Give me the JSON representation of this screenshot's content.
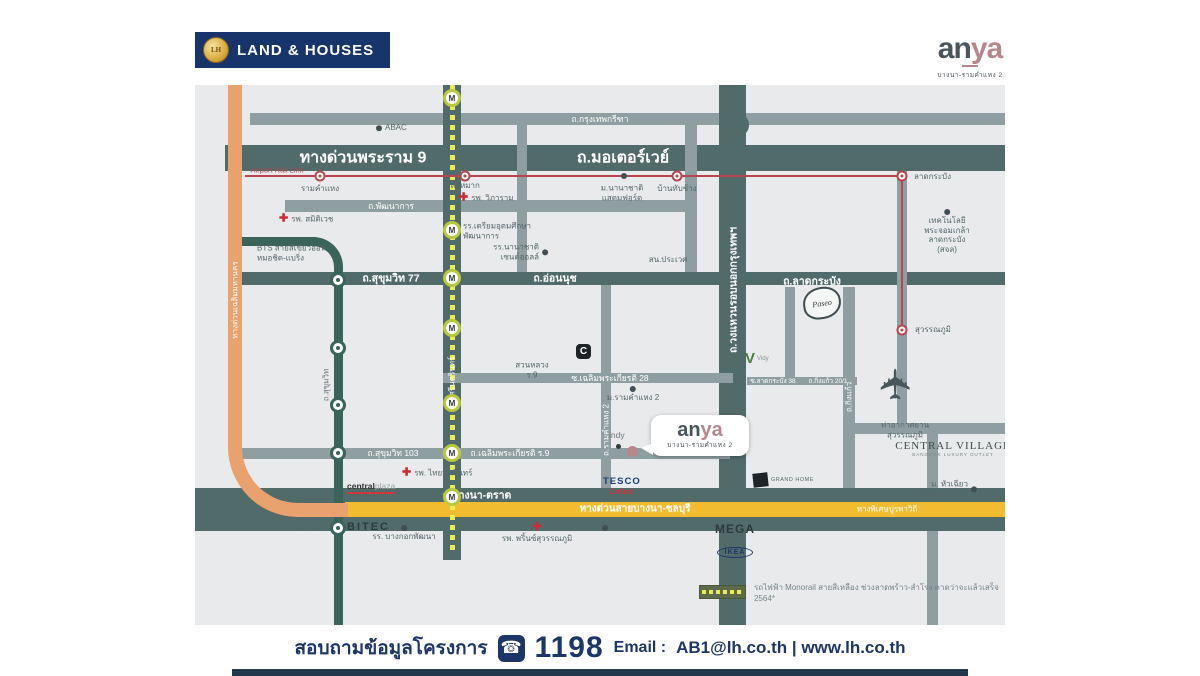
{
  "header": {
    "lh_logo_text": "LAND & HOUSES",
    "lh_coin": "LH",
    "anya_an": "an",
    "anya_ya": "ya",
    "anya_subtitle": "บางนา-รามคำแหง 2"
  },
  "bubble": {
    "an": "an",
    "ya": "ya",
    "subtitle": "บางนา-รามคำแหง 2"
  },
  "icons": {
    "plane": "✈",
    "phone": "☎",
    "cross": "✚",
    "monorail_station": "M"
  },
  "colors": {
    "navy": "#1c3667",
    "road_dark": "#516b6a",
    "road_medium": "#8f9fa1",
    "bts_green": "#3a635a",
    "monorail_yellow": "#e8ed55",
    "arl_red": "#b5454f",
    "expressway_orange": "#e9a16d",
    "bangna_yellow": "#f2bc30",
    "anya_pink": "#b5878c"
  },
  "logos": {
    "paseo": "Paseo",
    "v_mark": "V",
    "v_text": "Vidy",
    "grand_home": "GRAND HOME",
    "central_village_line1": "CENTRAL VILLAGE",
    "central_village_line2": "BANGKOK LUXURY OUTLET",
    "tesco": "TESCO",
    "lotus": "Lotus",
    "central": "central",
    "plaza": "plaza",
    "bitec": "BITEC",
    "mega": "MEGA",
    "mega_sub": "บางนา",
    "ikea": "IKEA",
    "indy": "indy",
    "c_mark": "C"
  },
  "legend": {
    "text": "รถไฟฟ้า Monorail สายสีเหลือง ช่วงลาดพร้าว-สำโรง คาดว่าจะแล้วเสร็จ 2564*"
  },
  "footer": {
    "inquiry_label": "สอบถามข้อมูลโครงการ",
    "phone_number": "1198",
    "email_label": "Email :",
    "contact_links": "AB1@lh.co.th | www.lh.co.th"
  },
  "map": {
    "road_labels": [
      {
        "t": "ถ.กรุงเทพกรีฑา",
        "x": 405,
        "y": 34,
        "c": "sm"
      },
      {
        "t": "ทางด่วนพระราม 9",
        "x": 168,
        "y": 73,
        "c": "big"
      },
      {
        "t": "ถ.มอเตอร์เวย์",
        "x": 428,
        "y": 73,
        "c": "big"
      },
      {
        "t": "ถ.พัฒนาการ",
        "x": 196,
        "y": 121,
        "c": "sm"
      },
      {
        "t": "ถ.สุขุมวิท 77",
        "x": 196,
        "y": 193,
        "c": "md"
      },
      {
        "t": "ถ.อ่อนนุช",
        "x": 360,
        "y": 193,
        "c": "md"
      },
      {
        "t": "ถ.ลาดกระบัง",
        "x": 617,
        "y": 196,
        "c": "md"
      },
      {
        "t": "ซ.เฉลิมพระเกียรติ 28",
        "x": 415,
        "y": 293,
        "c": "sm"
      },
      {
        "t": "ถ.สุขุมวิท 103",
        "x": 198,
        "y": 368,
        "c": "sm"
      },
      {
        "t": "ถ.เฉลิมพระเกียรติ ร.9",
        "x": 315,
        "y": 368,
        "c": "sm"
      },
      {
        "t": "ถ.บางนา-ตราด",
        "x": 282,
        "y": 410,
        "c": "md"
      },
      {
        "t": "ทางด่วนสายบางนา-ชลบุรี",
        "x": 440,
        "y": 424,
        "c": "md-y"
      },
      {
        "t": "ทางพิเศษบูรพาวิถี",
        "x": 692,
        "y": 424,
        "c": "sm-y"
      },
      {
        "t": "ซ.ลาดกระบัง 38",
        "x": 578,
        "y": 296,
        "c": "xs"
      },
      {
        "t": "ถ.กิ่งแก้ว 20/1",
        "x": 633,
        "y": 296,
        "c": "xs"
      },
      {
        "t": "ทางด่วนเฉลิมมหานคร",
        "x": 40,
        "y": 215,
        "c": "v"
      },
      {
        "t": "ถ.สุขุมวิท",
        "x": 131,
        "y": 300,
        "c": "v-dark"
      },
      {
        "t": "ถ.ศรีนครินทร์",
        "x": 257,
        "y": 295,
        "c": "v"
      },
      {
        "t": "ถ.รามคำแหง 2",
        "x": 411,
        "y": 345,
        "c": "v"
      },
      {
        "t": "ถ.วงแหวนรอบนอกกรุงเทพฯ",
        "x": 538,
        "y": 205,
        "c": "v-big"
      },
      {
        "t": "ถ.กิ่งแก้ว",
        "x": 654,
        "y": 312,
        "c": "v"
      }
    ],
    "pois": [
      {
        "k": "red-t",
        "lines": [
          "Airport Rail Link"
        ],
        "x": 82,
        "y": 85
      },
      {
        "k": "center",
        "lines": [
          "รามคำแหง"
        ],
        "x": 125,
        "y": 104
      },
      {
        "k": "center",
        "lines": [
          "หัวหมาก"
        ],
        "x": 270,
        "y": 101
      },
      {
        "k": "cross-left",
        "lines": [
          "รพ. วิภาราม"
        ],
        "x": 264,
        "y": 113
      },
      {
        "k": "dot-left",
        "lines": [
          "ABAC"
        ],
        "x": 181,
        "y": 43
      },
      {
        "k": "center",
        "lines": [
          "ม.นานาชาติ",
          "แสตมฟอร์ด"
        ],
        "x": 427,
        "y": 108
      },
      {
        "k": "center",
        "lines": [
          "บ้านทับช้าง"
        ],
        "x": 482,
        "y": 104
      },
      {
        "k": "left",
        "lines": [
          "ลาดกระบัง"
        ],
        "x": 719,
        "y": 92
      },
      {
        "k": "dot-above",
        "lines": [
          "เทคโนโลยี",
          "พระจอมเกล้า",
          "ลาดกระบัง",
          "(สจล)"
        ],
        "x": 752,
        "y": 124
      },
      {
        "k": "cross-left",
        "lines": [
          "รพ. สมิติเวช"
        ],
        "x": 84,
        "y": 134
      },
      {
        "k": "left",
        "lines": [
          "BTS สายสีเขียวอ่อน",
          "หมอชิต-แบริ่ง"
        ],
        "x": 62,
        "y": 168
      },
      {
        "k": "dot-left",
        "lines": [
          "รร.เตรียมอุดมศึกษา",
          "พัฒนาการ"
        ],
        "x": 259,
        "y": 146
      },
      {
        "k": "dot-right",
        "lines": [
          "รร.นานาชาติ",
          "เซนต์ออลล์"
        ],
        "x": 353,
        "y": 167
      },
      {
        "k": "center",
        "lines": [
          "สน.ประเวศ"
        ],
        "x": 473,
        "y": 175
      },
      {
        "k": "center",
        "lines": [
          "สวนหลวง",
          "ร.9"
        ],
        "x": 337,
        "y": 285
      },
      {
        "k": "dot-above",
        "lines": [
          "ม.รามคำแหง 2"
        ],
        "x": 438,
        "y": 301
      },
      {
        "k": "center",
        "lines": [
          "บางนา"
        ],
        "x": 115,
        "y": 443
      },
      {
        "k": "dot-above",
        "lines": [
          "รร. บางกอกพัฒนา"
        ],
        "x": 209,
        "y": 440
      },
      {
        "k": "cross-above",
        "lines": [
          "รพ. พริ้นซ์สุวรรณภูมิ"
        ],
        "x": 342,
        "y": 437
      },
      {
        "k": "cross-left",
        "lines": [
          "รพ. ไทยนครินทร์"
        ],
        "x": 207,
        "y": 388
      },
      {
        "k": "center",
        "lines": [
          "ท่าอากาศยาน",
          "สุวรรณภูมิ"
        ],
        "x": 710,
        "y": 345
      },
      {
        "k": "left",
        "lines": [
          "สุวรรณภูมิ"
        ],
        "x": 720,
        "y": 245
      },
      {
        "k": "dot-right",
        "lines": [
          "ม. หัวเฉียว",
          "เฉลิมพระเกียรติ"
        ],
        "x": 782,
        "y": 404
      }
    ],
    "dots": [
      [
        429,
        91
      ],
      [
        410,
        443
      ]
    ],
    "stations": {
      "bts": [
        [
          143,
          195
        ],
        [
          143,
          263
        ],
        [
          143,
          320
        ],
        [
          143,
          368
        ],
        [
          143,
          443
        ]
      ],
      "monorail": [
        [
          257,
          13
        ],
        [
          257,
          145
        ],
        [
          257,
          193
        ],
        [
          257,
          243
        ],
        [
          257,
          318
        ],
        [
          257,
          368
        ],
        [
          257,
          412
        ]
      ],
      "arl": [
        [
          125,
          91
        ],
        [
          270,
          91
        ],
        [
          482,
          91
        ],
        [
          707,
          91
        ],
        [
          707,
          245
        ]
      ]
    }
  }
}
